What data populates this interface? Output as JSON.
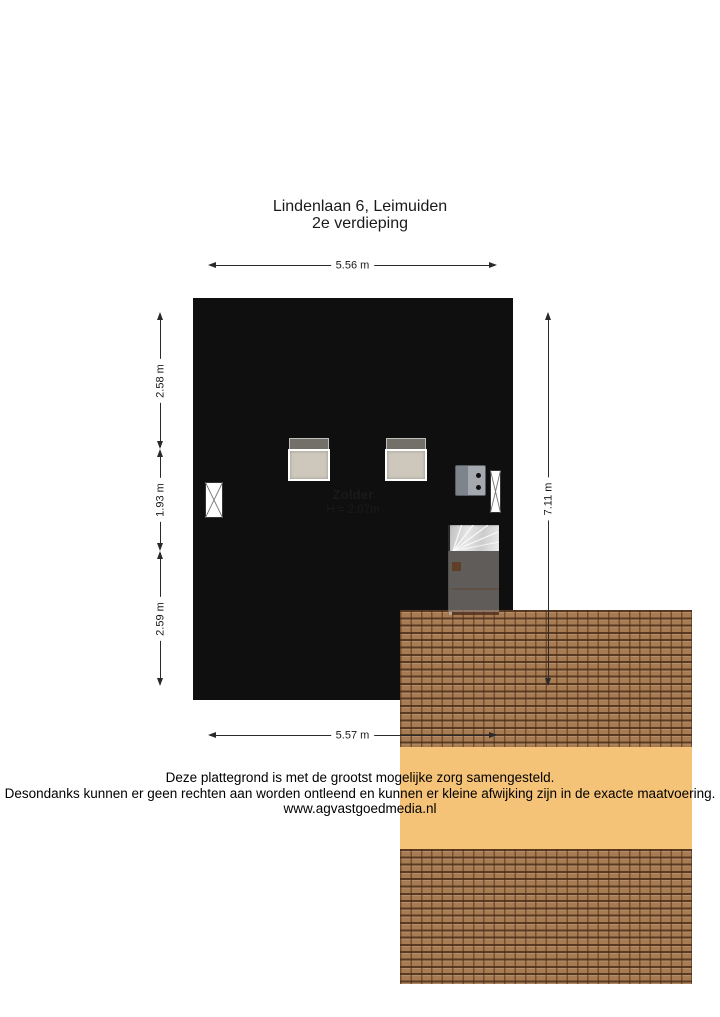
{
  "title": {
    "line1": "Lindenlaan 6, Leimuiden",
    "line2": "2e verdieping"
  },
  "room": {
    "name": "Zolder",
    "height": "H = 2.07m"
  },
  "dimensions": {
    "top": "5.56 m",
    "bottom": "5.57 m",
    "right": "7.11 m",
    "left_top": "2.58 m",
    "left_middle": "1.93 m",
    "left_bottom": "2.59 m"
  },
  "footer": {
    "line1": "Deze plattegrond is met de grootst mogelijke zorg samengesteld.",
    "line2": "Desondanks kunnen er geen rechten aan worden ontleend en kunnen er kleine afwijking zijn in de exacte maatvoering.",
    "line3": "www.agvastgoedmedia.nl"
  },
  "colors": {
    "wall": "#0f0f0f",
    "floor": "#f5c378",
    "roof_tile": "#a87c52",
    "roof_grout": "#5a361e",
    "skylight": "#cdc7bc",
    "stairs": "#d7d7d7",
    "boiler": "#9aa0a6",
    "dimension_line": "#2a2a2a",
    "text": "#1a1a1a",
    "background": "#ffffff"
  }
}
